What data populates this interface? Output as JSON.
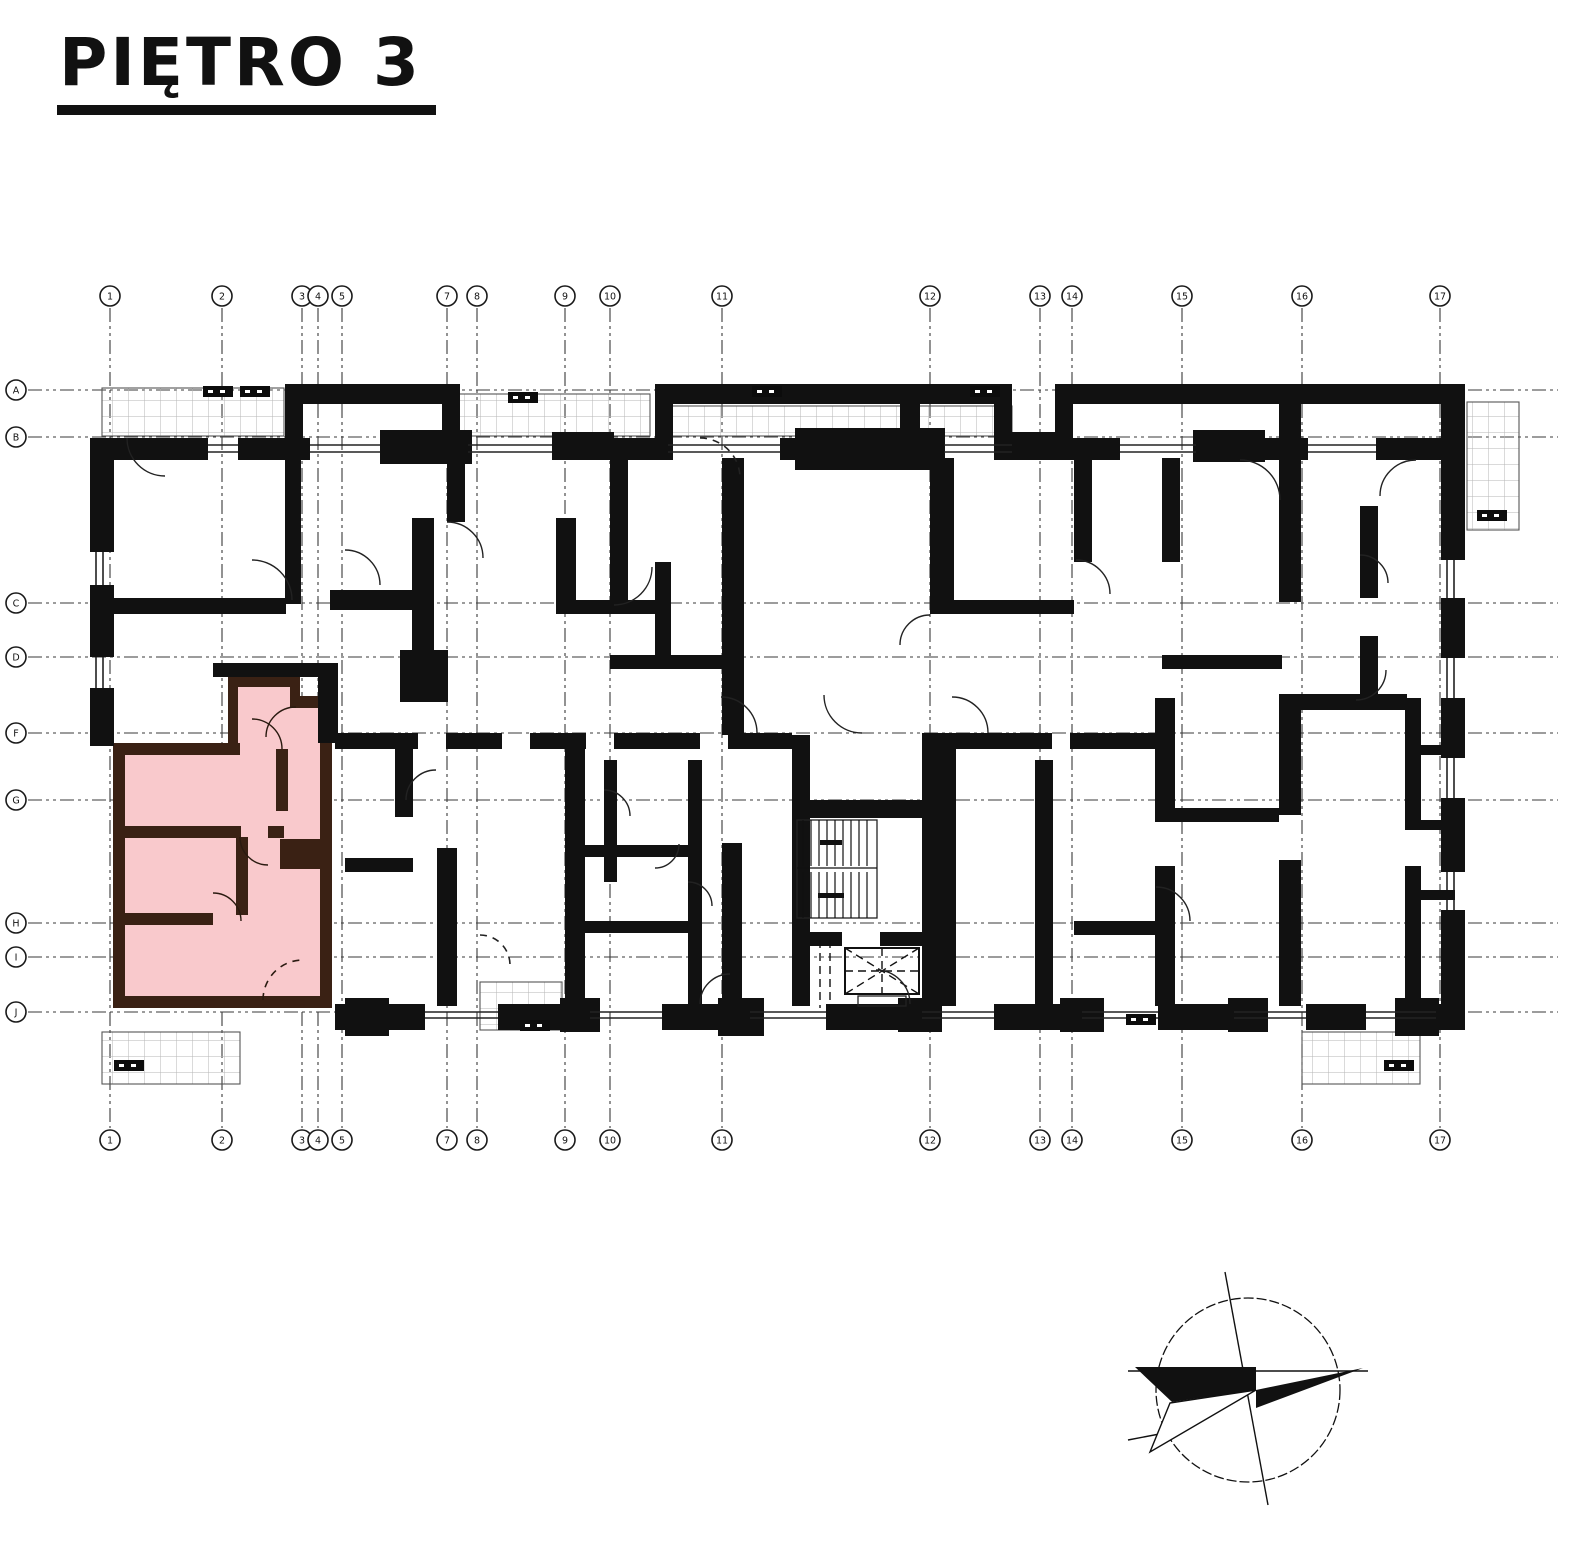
{
  "title": {
    "text": "PIĘTRO 3"
  },
  "grid": {
    "column_labels": [
      "1",
      "2",
      "3",
      "4",
      "5",
      "7",
      "8",
      "9",
      "10",
      "11",
      "12",
      "13",
      "14",
      "15",
      "16",
      "17"
    ],
    "column_x": [
      110,
      222,
      302,
      318,
      342,
      447,
      477,
      565,
      610,
      722,
      930,
      1040,
      1072,
      1182,
      1302,
      1440
    ],
    "column_bubble_top_y": 296,
    "column_bubble_bottom_y": 1140,
    "column_line_top_y": 308,
    "column_line_bottom_y": 1128,
    "row_labels": [
      "A",
      "B",
      "C",
      "D",
      "F",
      "G",
      "H",
      "I",
      "J"
    ],
    "row_y": [
      390,
      437,
      603,
      657,
      733,
      800,
      923,
      957,
      1012
    ],
    "row_bubble_x": 16,
    "row_line_x1": 28,
    "row_line_x2": 1558
  },
  "highlight": {
    "label": "highlighted-apartment-unit",
    "floor": "PIĘTRO 3"
  },
  "colors": {
    "wall": "#111111",
    "highlight_fill": "#f9c9cc",
    "highlight_wall": "#3a2114",
    "grid_line": "#3a3a3a",
    "hatch": "#b5b5b5",
    "background": "#ffffff"
  },
  "compass": {
    "name": "north-arrow"
  }
}
